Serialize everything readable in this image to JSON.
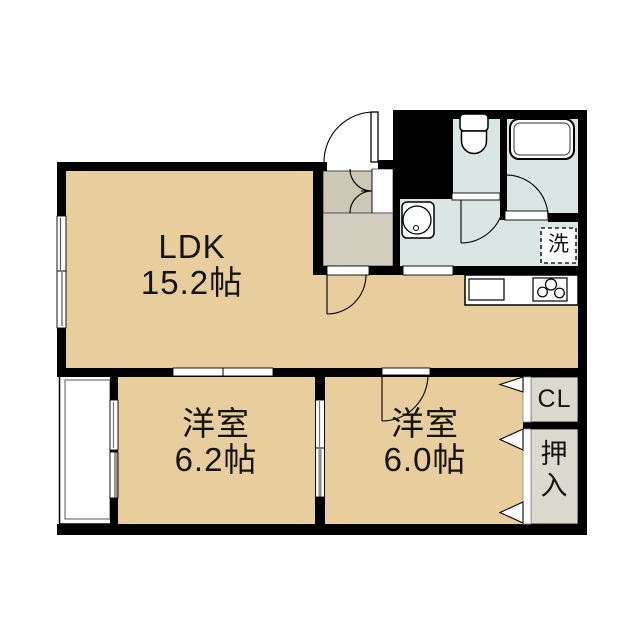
{
  "floor_plan": {
    "rooms": {
      "ldk": {
        "name": "LDK",
        "size": "15.2帖"
      },
      "bedroom_left": {
        "name": "洋室",
        "size": "6.2帖"
      },
      "bedroom_right": {
        "name": "洋室",
        "size": "6.0帖"
      },
      "closet": {
        "label": "CL"
      },
      "oshiire": {
        "label": "押入"
      },
      "laundry": {
        "label": "洗"
      }
    },
    "colors": {
      "floor_tan": "#e7ce9c",
      "wet_area_blue": "#d9e6e4",
      "hall_gray": "#cdc7b6",
      "hall_gray_light": "#d3cec0",
      "storage_gray": "#dcd9ce",
      "wall_black": "#000000"
    }
  }
}
